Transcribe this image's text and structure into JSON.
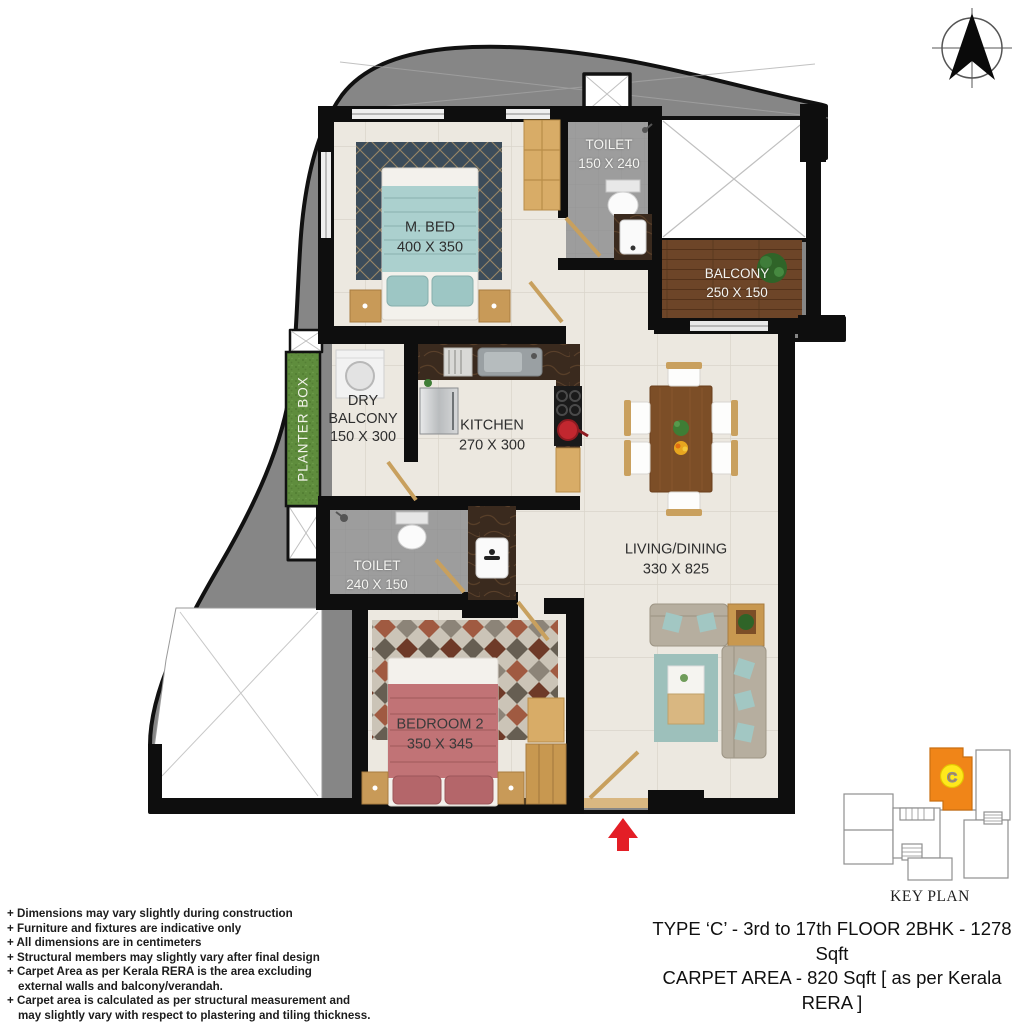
{
  "plan": {
    "rooms": {
      "m_bed": {
        "name": "M. BED",
        "dims": "400 X 350"
      },
      "toilet_top": {
        "name": "TOILET",
        "dims": "150 X 240"
      },
      "balcony": {
        "name": "BALCONY",
        "dims": "250 X 150"
      },
      "planter_box": {
        "name": "PLANTER BOX"
      },
      "dry_balcony": {
        "name": "DRY BALCONY",
        "dims": "150 X 300"
      },
      "kitchen": {
        "name": "KITCHEN",
        "dims": "270 X 300"
      },
      "toilet_common": {
        "name": "TOILET",
        "dims": "240 X 150"
      },
      "bedroom2": {
        "name": "BEDROOM 2",
        "dims": "350 X 345"
      },
      "living_dining": {
        "name": "LIVING/DINING",
        "dims": "330 X 825"
      }
    },
    "entry_arrow_color": "#E31E26"
  },
  "key_plan": {
    "caption": "KEY PLAN",
    "unit": "C",
    "unit_color": "#F08518",
    "badge_color": "#FFE81C"
  },
  "title": {
    "line1": "TYPE ‘C’ - 3rd to 17th FLOOR 2BHK - 1278 Sqft",
    "line2": "CARPET AREA - 820 Sqft [ as per Kerala RERA ]"
  },
  "notes": [
    "+ Dimensions may vary slightly during construction",
    "+ Furniture and fixtures are indicative only",
    "+ All dimensions are in centimeters",
    "+ Structural members may slightly vary after final design",
    "+ Carpet Area as per Kerala RERA is the area excluding",
    "external walls and balcony/verandah.",
    "+ Carpet area is calculated as per structural measurement and",
    "may slightly vary with respect to plastering and tiling thickness."
  ]
}
